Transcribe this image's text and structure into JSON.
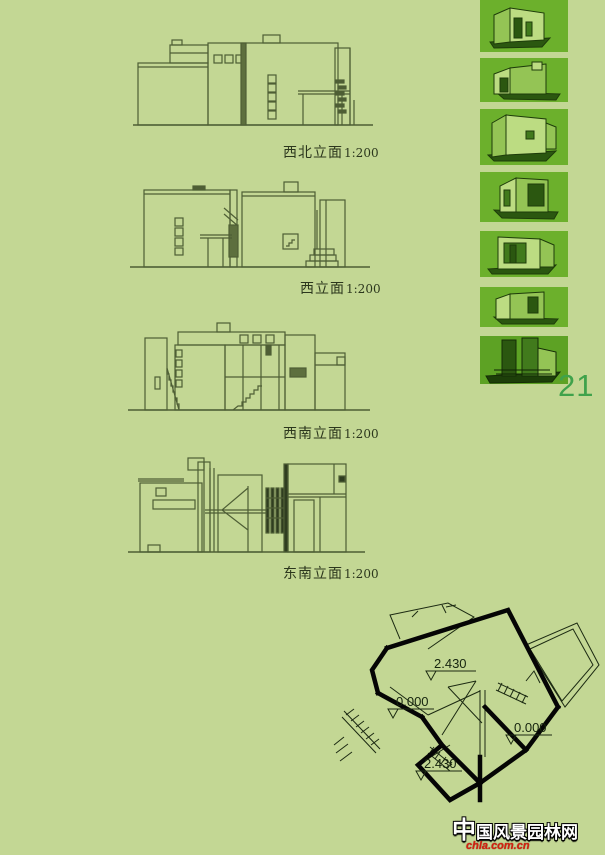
{
  "page": {
    "number": "21"
  },
  "elevations": [
    {
      "name": "northwest-elevation",
      "label": "西北立面",
      "scale": "1:200"
    },
    {
      "name": "west-elevation",
      "label": "西立面",
      "scale": "1:200"
    },
    {
      "name": "southwest-elevation",
      "label": "西南立面",
      "scale": "1:200"
    },
    {
      "name": "southeast-elevation",
      "label": "东南立面",
      "scale": "1:200"
    }
  ],
  "sidebar_thumbnails": {
    "count": 7,
    "items": [
      "axon-view-1",
      "axon-view-2",
      "axon-view-3",
      "axon-view-4",
      "axon-view-5",
      "axon-view-6",
      "axon-view-7"
    ]
  },
  "floor_plan": {
    "level_labels": [
      "2.430",
      "0.000",
      "0.000",
      "2.430"
    ]
  },
  "watermark": {
    "site_name": "中国风景园林网",
    "site_url": "chla.com.cn"
  },
  "colors": {
    "page_background": "#c3d794",
    "drawing_line": "#4e5e35",
    "plan_line": "#000000",
    "thumbnail_background": "#6cb02c",
    "page_number_green": "#3fa24b",
    "watermark_red": "#d41f0f"
  }
}
